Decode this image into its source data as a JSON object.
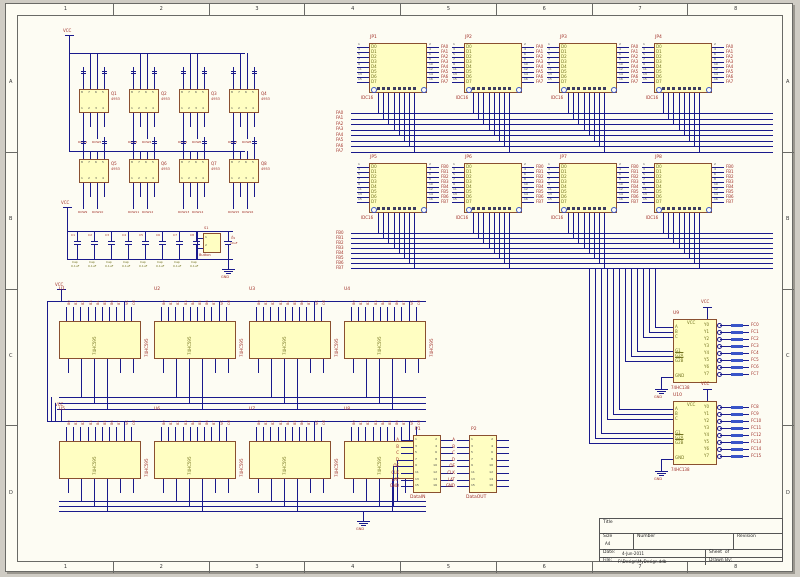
{
  "colors": {
    "wire": "#1a1a8c",
    "part_fill": "#fffec2",
    "part_border": "#8a5030",
    "net_label": "#a03028",
    "pin_name": "#72721e",
    "pin_number": "#444444",
    "pad_blue": "#3a55c8",
    "sheet_bg": "#fdfcf3",
    "page_bg": "#cfccc4"
  },
  "ruler": {
    "columns": [
      "1",
      "2",
      "3",
      "4",
      "5",
      "6",
      "7",
      "8"
    ],
    "rows": [
      "A",
      "B",
      "C",
      "D"
    ]
  },
  "title_block": {
    "title_label": "Title",
    "size_label": "Size",
    "size_value": "A4",
    "number_label": "Number",
    "revision_label": "Revision",
    "date_label": "Date:",
    "date_value": "4-Jun-2011",
    "sheet_label": "Sheet  of",
    "file_label": "File:",
    "file_value": "F:\\Design\\MyDesign.ddb",
    "drawn_label": "Drawn By:"
  },
  "power": {
    "vcc": "VCC",
    "gnd": "GND"
  },
  "row_drivers": {
    "value": "4953",
    "pin_numbers_top": [
      "8",
      "7",
      "6",
      "5"
    ],
    "pin_numbers_bottom": [
      "1",
      "2",
      "3",
      "4"
    ],
    "items": [
      {
        "ref": "Q1",
        "x": 78,
        "y": 88,
        "nets": [
          "ROW1",
          "ROW2"
        ]
      },
      {
        "ref": "Q2",
        "x": 128,
        "y": 88,
        "nets": [
          "ROW3",
          "ROW4"
        ]
      },
      {
        "ref": "Q3",
        "x": 178,
        "y": 88,
        "nets": [
          "ROW5",
          "ROW6"
        ]
      },
      {
        "ref": "Q4",
        "x": 228,
        "y": 88,
        "nets": [
          "ROW7",
          "ROW8"
        ]
      },
      {
        "ref": "Q5",
        "x": 78,
        "y": 158,
        "nets": [
          "ROW9",
          "ROW10"
        ]
      },
      {
        "ref": "Q6",
        "x": 128,
        "y": 158,
        "nets": [
          "ROW11",
          "ROW12"
        ]
      },
      {
        "ref": "Q7",
        "x": 178,
        "y": 158,
        "nets": [
          "ROW13",
          "ROW14"
        ]
      },
      {
        "ref": "Q8",
        "x": 228,
        "y": 158,
        "nets": [
          "ROW15",
          "ROW16"
        ]
      }
    ]
  },
  "caps": {
    "name": "Cap",
    "value": "0.1uF",
    "refs": [
      "C1",
      "C2",
      "C3",
      "C4",
      "C5",
      "C6",
      "C7",
      "C8"
    ],
    "switch_ref": "S1",
    "switch_value": "Button",
    "pol_ref": "C9",
    "pol_value": "10uF"
  },
  "headers": {
    "part": "IDC16",
    "pin_names": [
      "D0",
      "D1",
      "D2",
      "D3",
      "D4",
      "D5",
      "D6",
      "D7"
    ],
    "xs": [
      368,
      463,
      558,
      653
    ],
    "rows": [
      {
        "y": 42,
        "bus_y": 112,
        "step": 5.5,
        "refs": [
          "JP1",
          "JP2",
          "JP3",
          "JP4"
        ],
        "nets": [
          "FA0",
          "FA1",
          "FA2",
          "FA3",
          "FA4",
          "FA5",
          "FA6",
          "FA7"
        ]
      },
      {
        "y": 162,
        "bus_y": 232,
        "step": 5,
        "refs": [
          "JP5",
          "JP6",
          "JP7",
          "JP8"
        ],
        "nets": [
          "FB0",
          "FB1",
          "FB2",
          "FB3",
          "FB4",
          "FB5",
          "FB6",
          "FB7"
        ]
      }
    ]
  },
  "shift_registers": {
    "part": "74HC595",
    "top_nets": [
      "B0",
      "B1",
      "B2",
      "B3",
      "B4",
      "B5",
      "B6",
      "B7",
      "VC",
      "OE"
    ],
    "items": [
      {
        "ref": "U1",
        "x": 58,
        "y": 320
      },
      {
        "ref": "U2",
        "x": 153,
        "y": 320
      },
      {
        "ref": "U3",
        "x": 248,
        "y": 320
      },
      {
        "ref": "U4",
        "x": 343,
        "y": 320
      },
      {
        "ref": "U5",
        "x": 58,
        "y": 440
      },
      {
        "ref": "U6",
        "x": 153,
        "y": 440
      },
      {
        "ref": "U7",
        "x": 248,
        "y": 440
      },
      {
        "ref": "U8",
        "x": 343,
        "y": 440
      }
    ]
  },
  "decoders": {
    "part": "74HC138",
    "x": 672,
    "left_pins": [
      "A",
      "B",
      "C",
      "G1",
      "G2A",
      "G2B"
    ],
    "right_pins": [
      "Y0",
      "Y1",
      "Y2",
      "Y3",
      "Y4",
      "Y5",
      "Y6",
      "Y7"
    ],
    "items": [
      {
        "ref": "U9",
        "y": 318,
        "nets": [
          "FC0",
          "FC1",
          "FC2",
          "FC3",
          "FC4",
          "FC5",
          "FC6",
          "FC7"
        ]
      },
      {
        "ref": "U10",
        "y": 400,
        "nets": [
          "FC8",
          "FC9",
          "FC10",
          "FC11",
          "FC12",
          "FC13",
          "FC14",
          "FC15"
        ]
      }
    ]
  },
  "connectors": {
    "y": 434,
    "left_nets": [
      "A",
      "B",
      "C",
      "D",
      "OE",
      "CLK",
      "LAT",
      "GND"
    ],
    "items": [
      {
        "ref": "P1",
        "x": 412,
        "name": "DataIN"
      },
      {
        "ref": "P2",
        "x": 468,
        "name": "DataOUT"
      }
    ]
  }
}
